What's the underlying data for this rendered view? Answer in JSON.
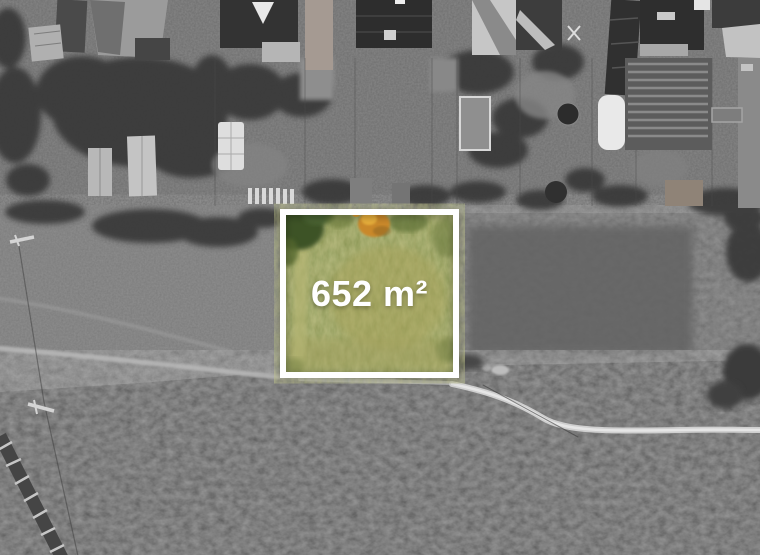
{
  "plot": {
    "area_label": "652 m²",
    "highlight": {
      "border_color": "#ffffff",
      "grass_green": "#87914d",
      "grass_light": "#a8a258",
      "bush_dark": "#3e5226",
      "autumn_tree_orange": "#c9882a"
    }
  },
  "background": {
    "style": "grayscale-aerial-photo",
    "tones": {
      "gardens_band": "#6d6d6d",
      "meadow": "#7a7a7a",
      "rough_field": "#595959",
      "roof_dark": "#2e2e2e",
      "roof_light": "#c6c6c6",
      "track_light": "#d6d6d6"
    }
  }
}
